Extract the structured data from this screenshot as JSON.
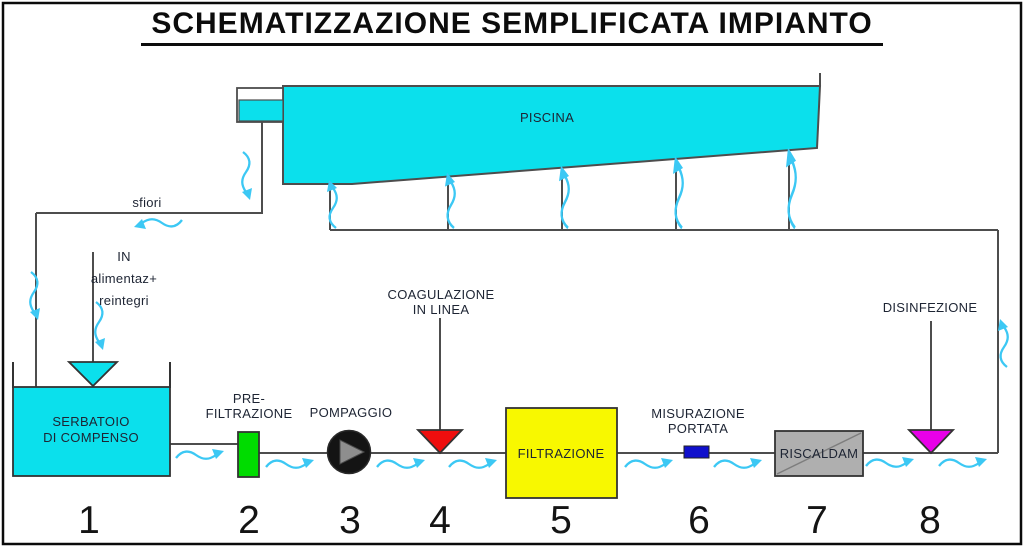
{
  "title": "SCHEMATIZZAZIONE SEMPLIFICATA IMPIANTO",
  "pool": {
    "label": "PISCINA",
    "overflow_label": "sfiori"
  },
  "feed": {
    "line1": "IN",
    "line2": "alimentaz+",
    "line3": "reintegri"
  },
  "components": [
    {
      "number": "1",
      "line1": "SERBATOIO",
      "line2": "DI COMPENSO"
    },
    {
      "number": "2",
      "line1": "PRE-",
      "line2": "FILTRAZIONE"
    },
    {
      "number": "3",
      "line1": "POMPAGGIO",
      "line2": ""
    },
    {
      "number": "4",
      "line1": "COAGULAZIONE",
      "line2": "IN LINEA"
    },
    {
      "number": "5",
      "line1": "FILTRAZIONE",
      "line2": ""
    },
    {
      "number": "6",
      "line1": "MISURAZIONE",
      "line2": "PORTATA"
    },
    {
      "number": "7",
      "line1": "RISCALDAM",
      "line2": ""
    },
    {
      "number": "8",
      "line1": "DISINFEZIONE",
      "line2": ""
    }
  ],
  "colors": {
    "water": "#0be0ec",
    "flow_arrow": "#3cc8f4",
    "prefilter": "#00dc00",
    "coagulant": "#ee0e0e",
    "filter": "#f8f800",
    "flow_meter": "#1010cc",
    "heater": "#afafaf",
    "disinfectant": "#e800e8",
    "pipe": "#4d4d4d"
  }
}
